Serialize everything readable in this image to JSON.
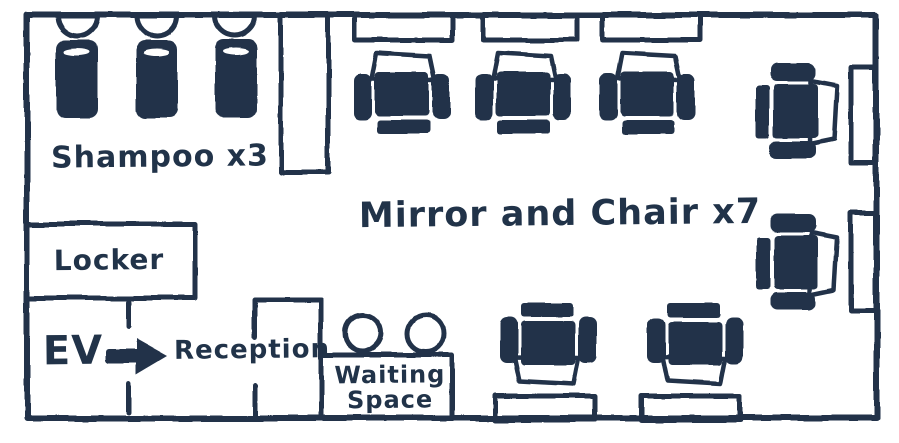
{
  "ink_color": "#213349",
  "background_color": "#ffffff",
  "labels": {
    "shampoo": "Shampoo x3",
    "mirror_chair": "Mirror and Chair x7",
    "locker": "Locker",
    "elevator": "EV",
    "reception": "Reception",
    "waiting_line1": "Waiting",
    "waiting_line2": "Space"
  },
  "counts": {
    "shampoo_stations": 3,
    "mirror_chair_stations": 7,
    "waiting_stools": 2
  },
  "icons": {
    "elevator_direction": "right-arrow"
  }
}
